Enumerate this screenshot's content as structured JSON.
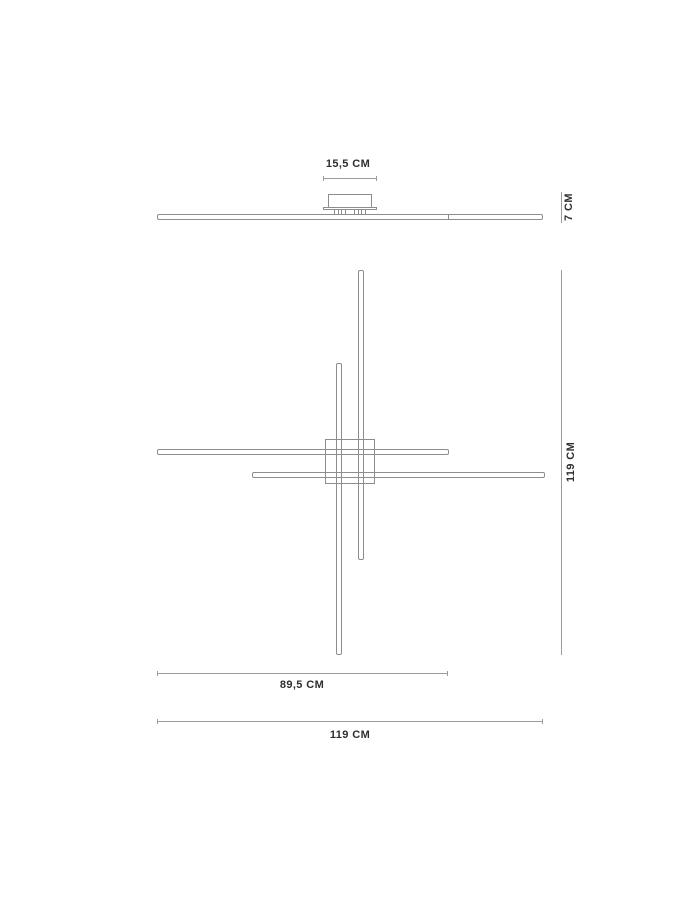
{
  "colors": {
    "background": "#ffffff",
    "line": "#8d8d8d",
    "dim": "#9b9b9b",
    "text": "#2f2f2f"
  },
  "side_view": {
    "canopy_width_label": "15,5 CM",
    "height_label": "7 CM"
  },
  "top_view": {
    "bar_length_label": "89,5 CM",
    "overall_width_label": "119 CM",
    "overall_height_label": "119 CM"
  }
}
